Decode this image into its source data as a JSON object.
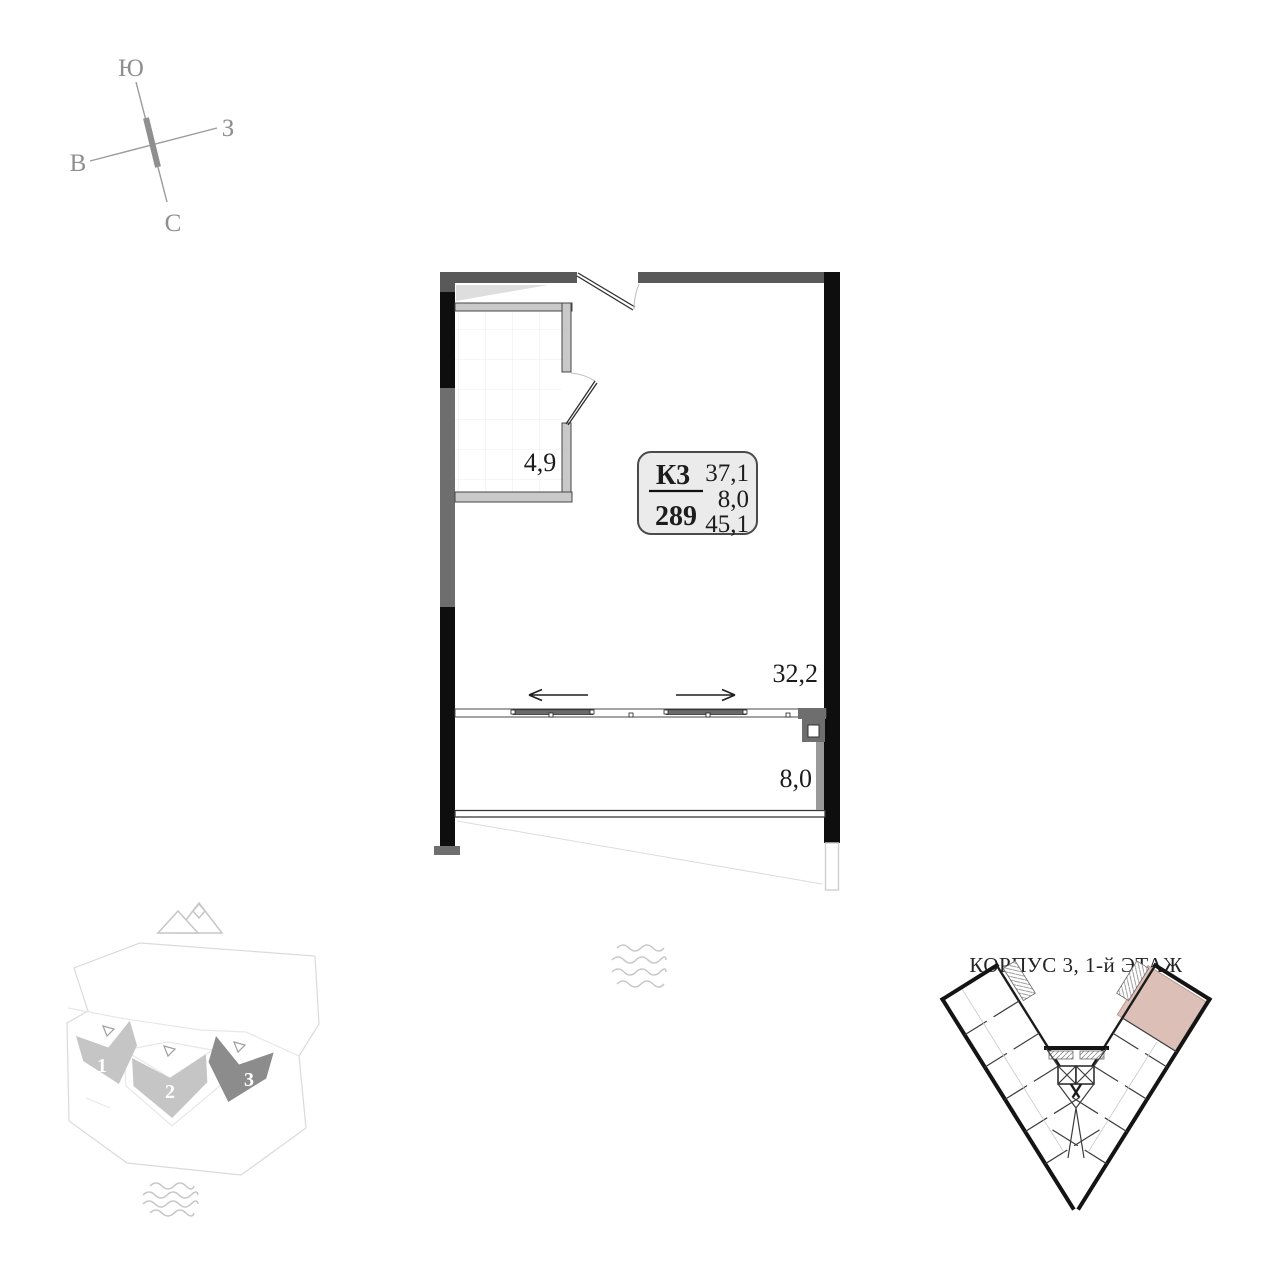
{
  "colors": {
    "wall-black": "#0e0e0e",
    "wall-gray": "#595959",
    "wall-gray-light": "#6e6e6e",
    "partition-fill": "#c9c9c9",
    "partition-stroke": "#454545",
    "text-dark": "#1c1c1c",
    "arc-gray": "#c2c2c2",
    "infobox-fill": "#ebebeb",
    "highlight-pink": "#dcbfb6",
    "highlight-pink-stroke": "#bb9c93",
    "site-gray": "#c5c5c5",
    "site-dark": "#8c8c8c",
    "icon-gray": "#c6c6c6",
    "compass-gray": "#8f8f8f",
    "faint-gray": "#dcdcdc"
  },
  "compass": {
    "top": "Ю",
    "right": "З",
    "left": "В",
    "bottom": "С"
  },
  "apartment": {
    "bathroom_area": "4,9",
    "room_area": "32,2",
    "balcony_area": "8,0",
    "info_box": {
      "building_code": "К3",
      "unit_number": "289",
      "area_main": "37,1",
      "area_balcony": "8,0",
      "area_total": "45,1"
    }
  },
  "mini_plan": {
    "title": "КОРПУС 3, 1-й ЭТАЖ"
  },
  "site_plan": {
    "buildings": [
      {
        "label": "1"
      },
      {
        "label": "2"
      },
      {
        "label": "3"
      }
    ]
  }
}
